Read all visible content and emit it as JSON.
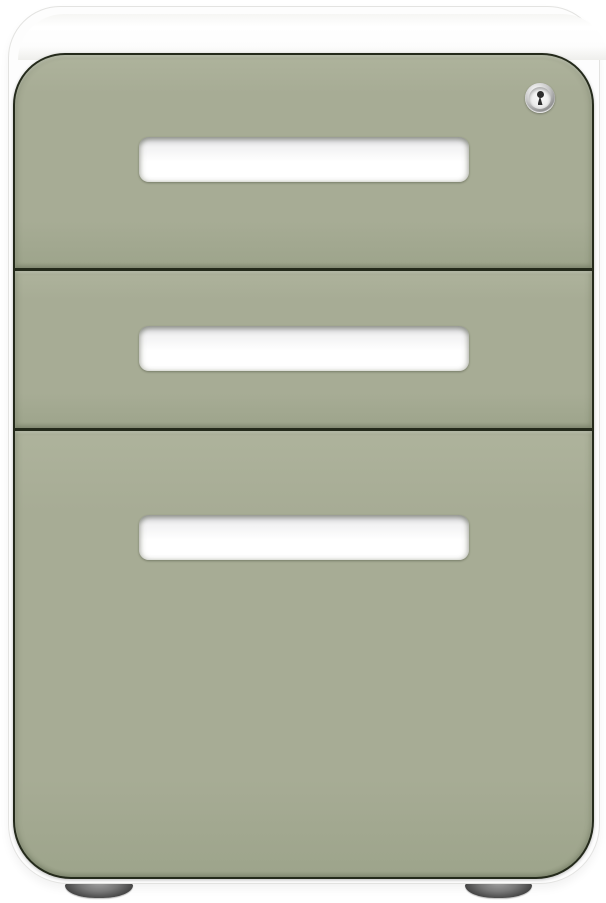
{
  "scene": {
    "type": "product-photo",
    "subject": "3-drawer mobile pedestal file cabinet on white background"
  },
  "cabinet": {
    "shell_color_name": "white",
    "drawer_color_name": "sage green",
    "drawers": [
      {
        "label": "top drawer",
        "handle": "recessed scoop handle",
        "has_lock": true
      },
      {
        "label": "middle drawer",
        "handle": "recessed scoop handle",
        "has_lock": false
      },
      {
        "label": "bottom file drawer",
        "handle": "recessed scoop handle",
        "has_lock": false
      }
    ],
    "lock": {
      "icon": "keyhole-lock-icon",
      "description": "round chrome keyhole lock"
    },
    "wheels": [
      {
        "icon": "caster-wheel",
        "position": "front-left"
      },
      {
        "icon": "caster-wheel",
        "position": "front-right"
      }
    ]
  },
  "colors": {
    "background": "#ffffff",
    "shell-white": "#fdfdfd",
    "shell-edge": "#e3e3e1",
    "green-base": "#a7ac95",
    "green-light": "#aeb39c",
    "green-dark": "#9da48b",
    "seam-dark": "#242a1b",
    "handle-white": "#ffffff",
    "chrome-light": "#efefef",
    "chrome-mid": "#c7c7c7",
    "chrome-dark": "#8e8e8e",
    "keyhole-dark": "#2d2d2d",
    "wheel-light": "#a8a8a8",
    "wheel-dark": "#3f3f3f"
  }
}
